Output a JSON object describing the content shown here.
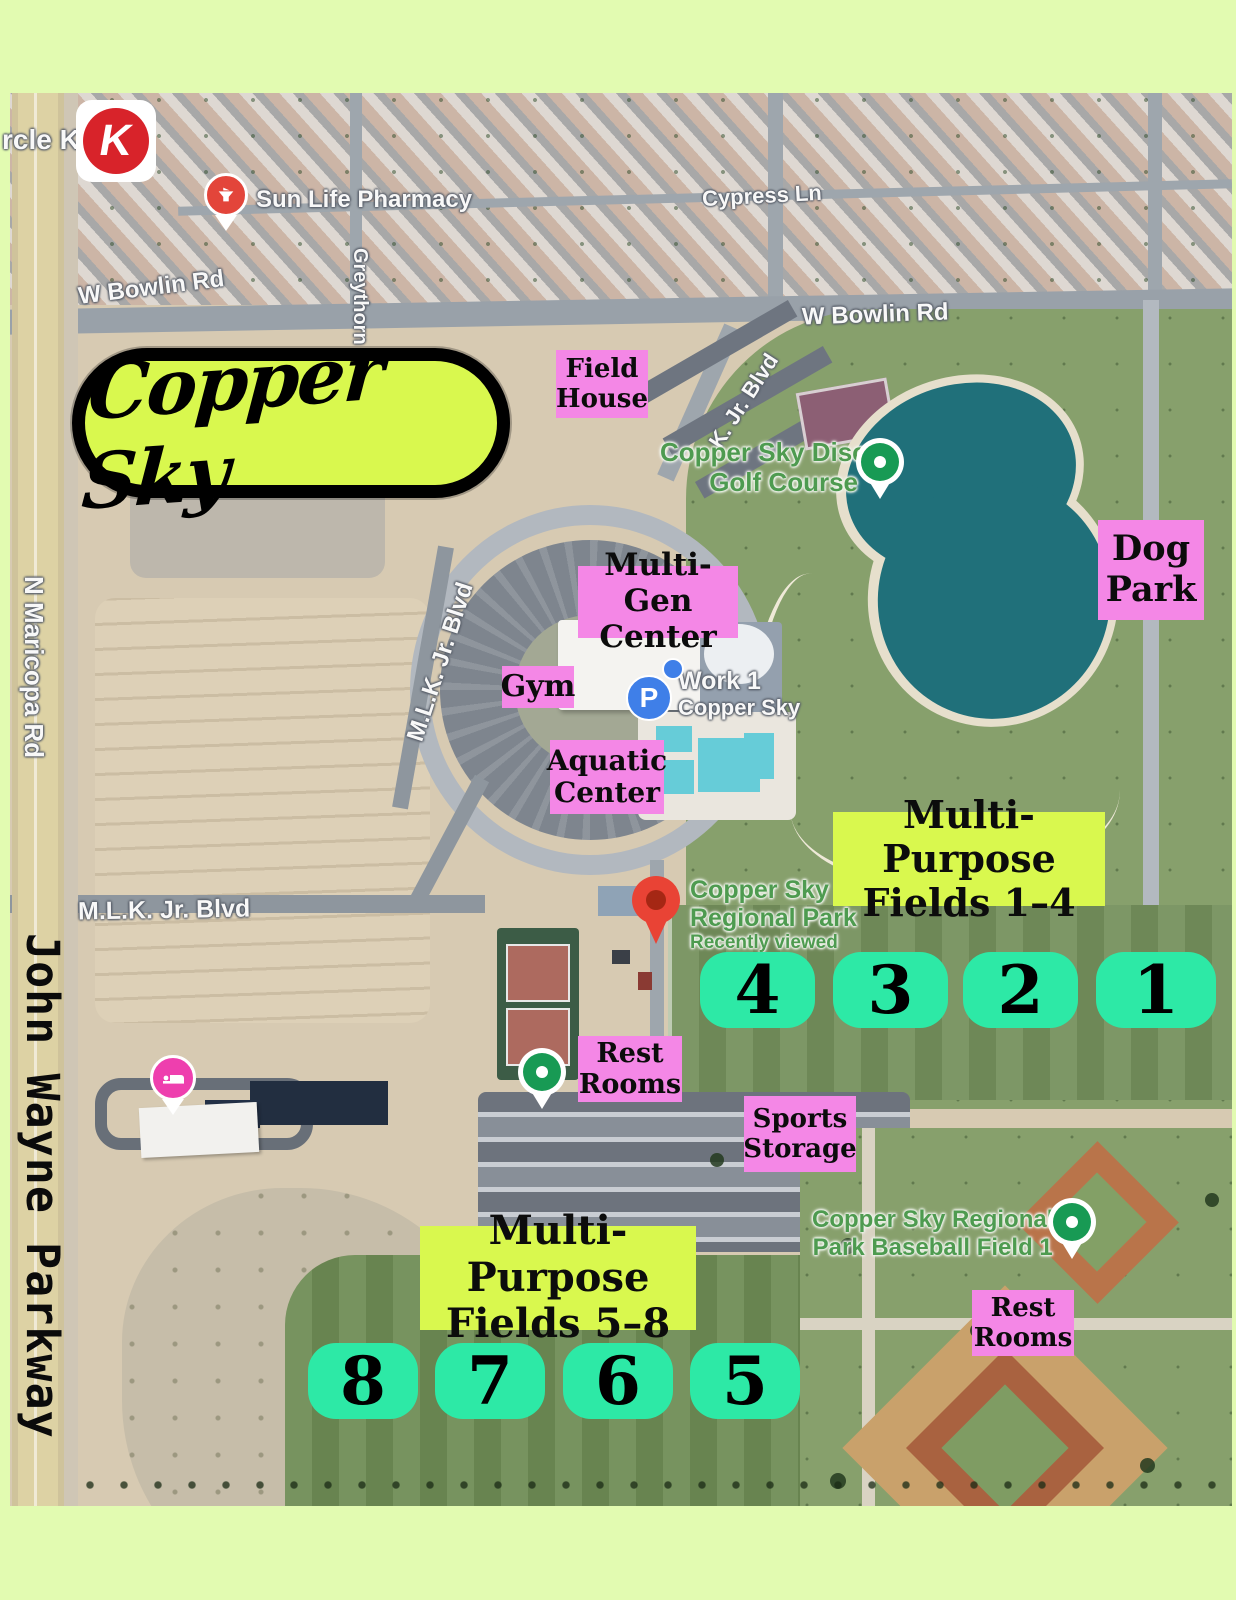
{
  "colors": {
    "frame": "#e2fbb1",
    "pink_label": "#f487e6",
    "lime_label": "#d9f84e",
    "teal_tile": "#2de9a6",
    "logo_bg": "#d9f84e",
    "lake": "#20707a",
    "map_green_text": "#4e9b50"
  },
  "logo": {
    "text": "Copper Sky"
  },
  "roads": {
    "john_wayne_parkway": "John Wayne Parkway",
    "n_maricopa_rd": "N Maricopa Rd",
    "w_bowlin_rd_left": "W Bowlin Rd",
    "w_bowlin_rd_right": "W Bowlin Rd",
    "cypress_ln": "Cypress Ln",
    "greythorn": "Greythorn",
    "mlk_blvd_lower": "M.L.K. Jr. Blvd",
    "mlk_blvd_mid": "M.L.K. Jr. Blvd",
    "mlk_blvd_upper": "K. Jr. Blvd"
  },
  "pois": {
    "circle_k_text": "rcle K",
    "circle_k_letter": "K",
    "sun_life_pharmacy": "Sun Life Pharmacy",
    "disc_golf_line1": "Copper Sky Disc",
    "disc_golf_line2": "Golf Course",
    "parking_letter": "P",
    "work1_line1": "Work 1",
    "work1_line2": "Copper Sky",
    "regional_park_line1": "Copper Sky",
    "regional_park_line2": "Regional Park",
    "regional_park_sub": "Recently viewed",
    "baseball_line1": "Copper Sky Regional",
    "baseball_line2": "Park Baseball Field 1"
  },
  "labels": {
    "field_house": [
      "Field",
      "House"
    ],
    "multi_gen": [
      "Multi-Gen",
      "Center"
    ],
    "gym": [
      "Gym"
    ],
    "aquatic": [
      "Aquatic",
      "Center"
    ],
    "dog_park": [
      "Dog",
      "Park"
    ],
    "rest_rooms_1": [
      "Rest",
      "Rooms"
    ],
    "sports_storage": [
      "Sports",
      "Storage"
    ],
    "rest_rooms_2": [
      "Rest",
      "Rooms"
    ],
    "fields_1_4": [
      "Multi-Purpose",
      "Fields 1–4"
    ],
    "fields_5_8": [
      "Multi-Purpose",
      "Fields 5–8"
    ]
  },
  "field_numbers": {
    "group_1_4": [
      "4",
      "3",
      "2",
      "1"
    ],
    "group_5_8": [
      "8",
      "7",
      "6",
      "5"
    ]
  }
}
